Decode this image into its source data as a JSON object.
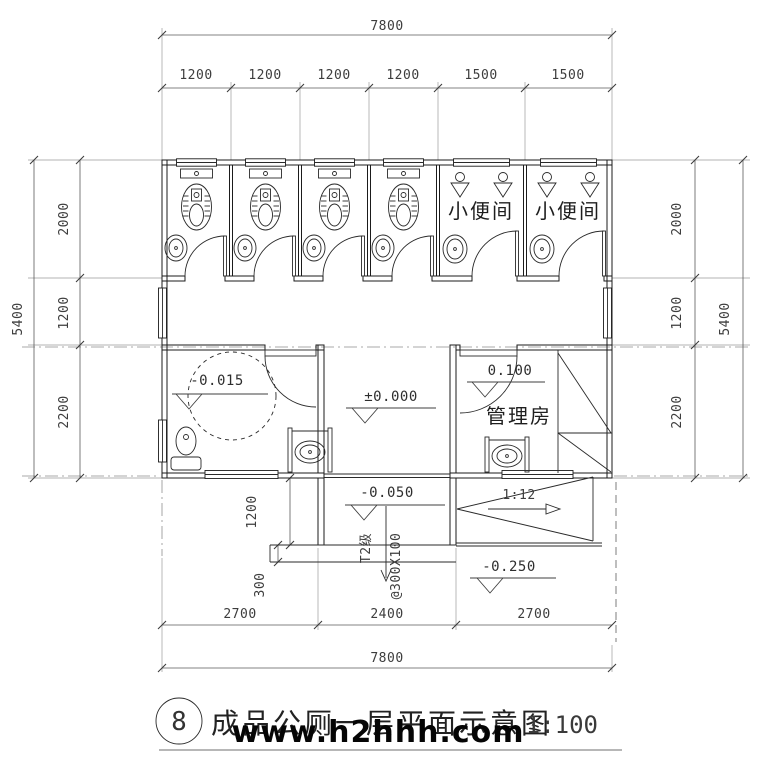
{
  "title": {
    "number": "8",
    "text": "成品公厕一层平面示意图",
    "scale": "1:100",
    "watermark": "www.h2hhh.com"
  },
  "dimensions": {
    "top_total": "7800",
    "top_segments": [
      "1200",
      "1200",
      "1200",
      "1200",
      "1500",
      "1500"
    ],
    "left_total": "5400",
    "left_segments": [
      "2000",
      "1200",
      "2200"
    ],
    "right_total": "5400",
    "right_segments": [
      "2000",
      "1200",
      "2200"
    ],
    "bottom_segments": [
      "2700",
      "2400",
      "2700"
    ],
    "bottom_total": "7800",
    "porch_depth": "1200",
    "step_depth": "300"
  },
  "levels": {
    "entry": "±0.000",
    "accessible": "-0.015",
    "manager": "0.100",
    "porch": "-0.050",
    "grade": "-0.250"
  },
  "rooms": {
    "urinal_a": "小便间",
    "urinal_b": "小便间",
    "manager": "管理房"
  },
  "annotations": {
    "steps": "T2级",
    "tread": "@300X100",
    "ramp_slope": "1:12"
  },
  "colors": {
    "line": "#1b1b1b",
    "aux": "#9a9a9a",
    "watermark": "#050505"
  }
}
